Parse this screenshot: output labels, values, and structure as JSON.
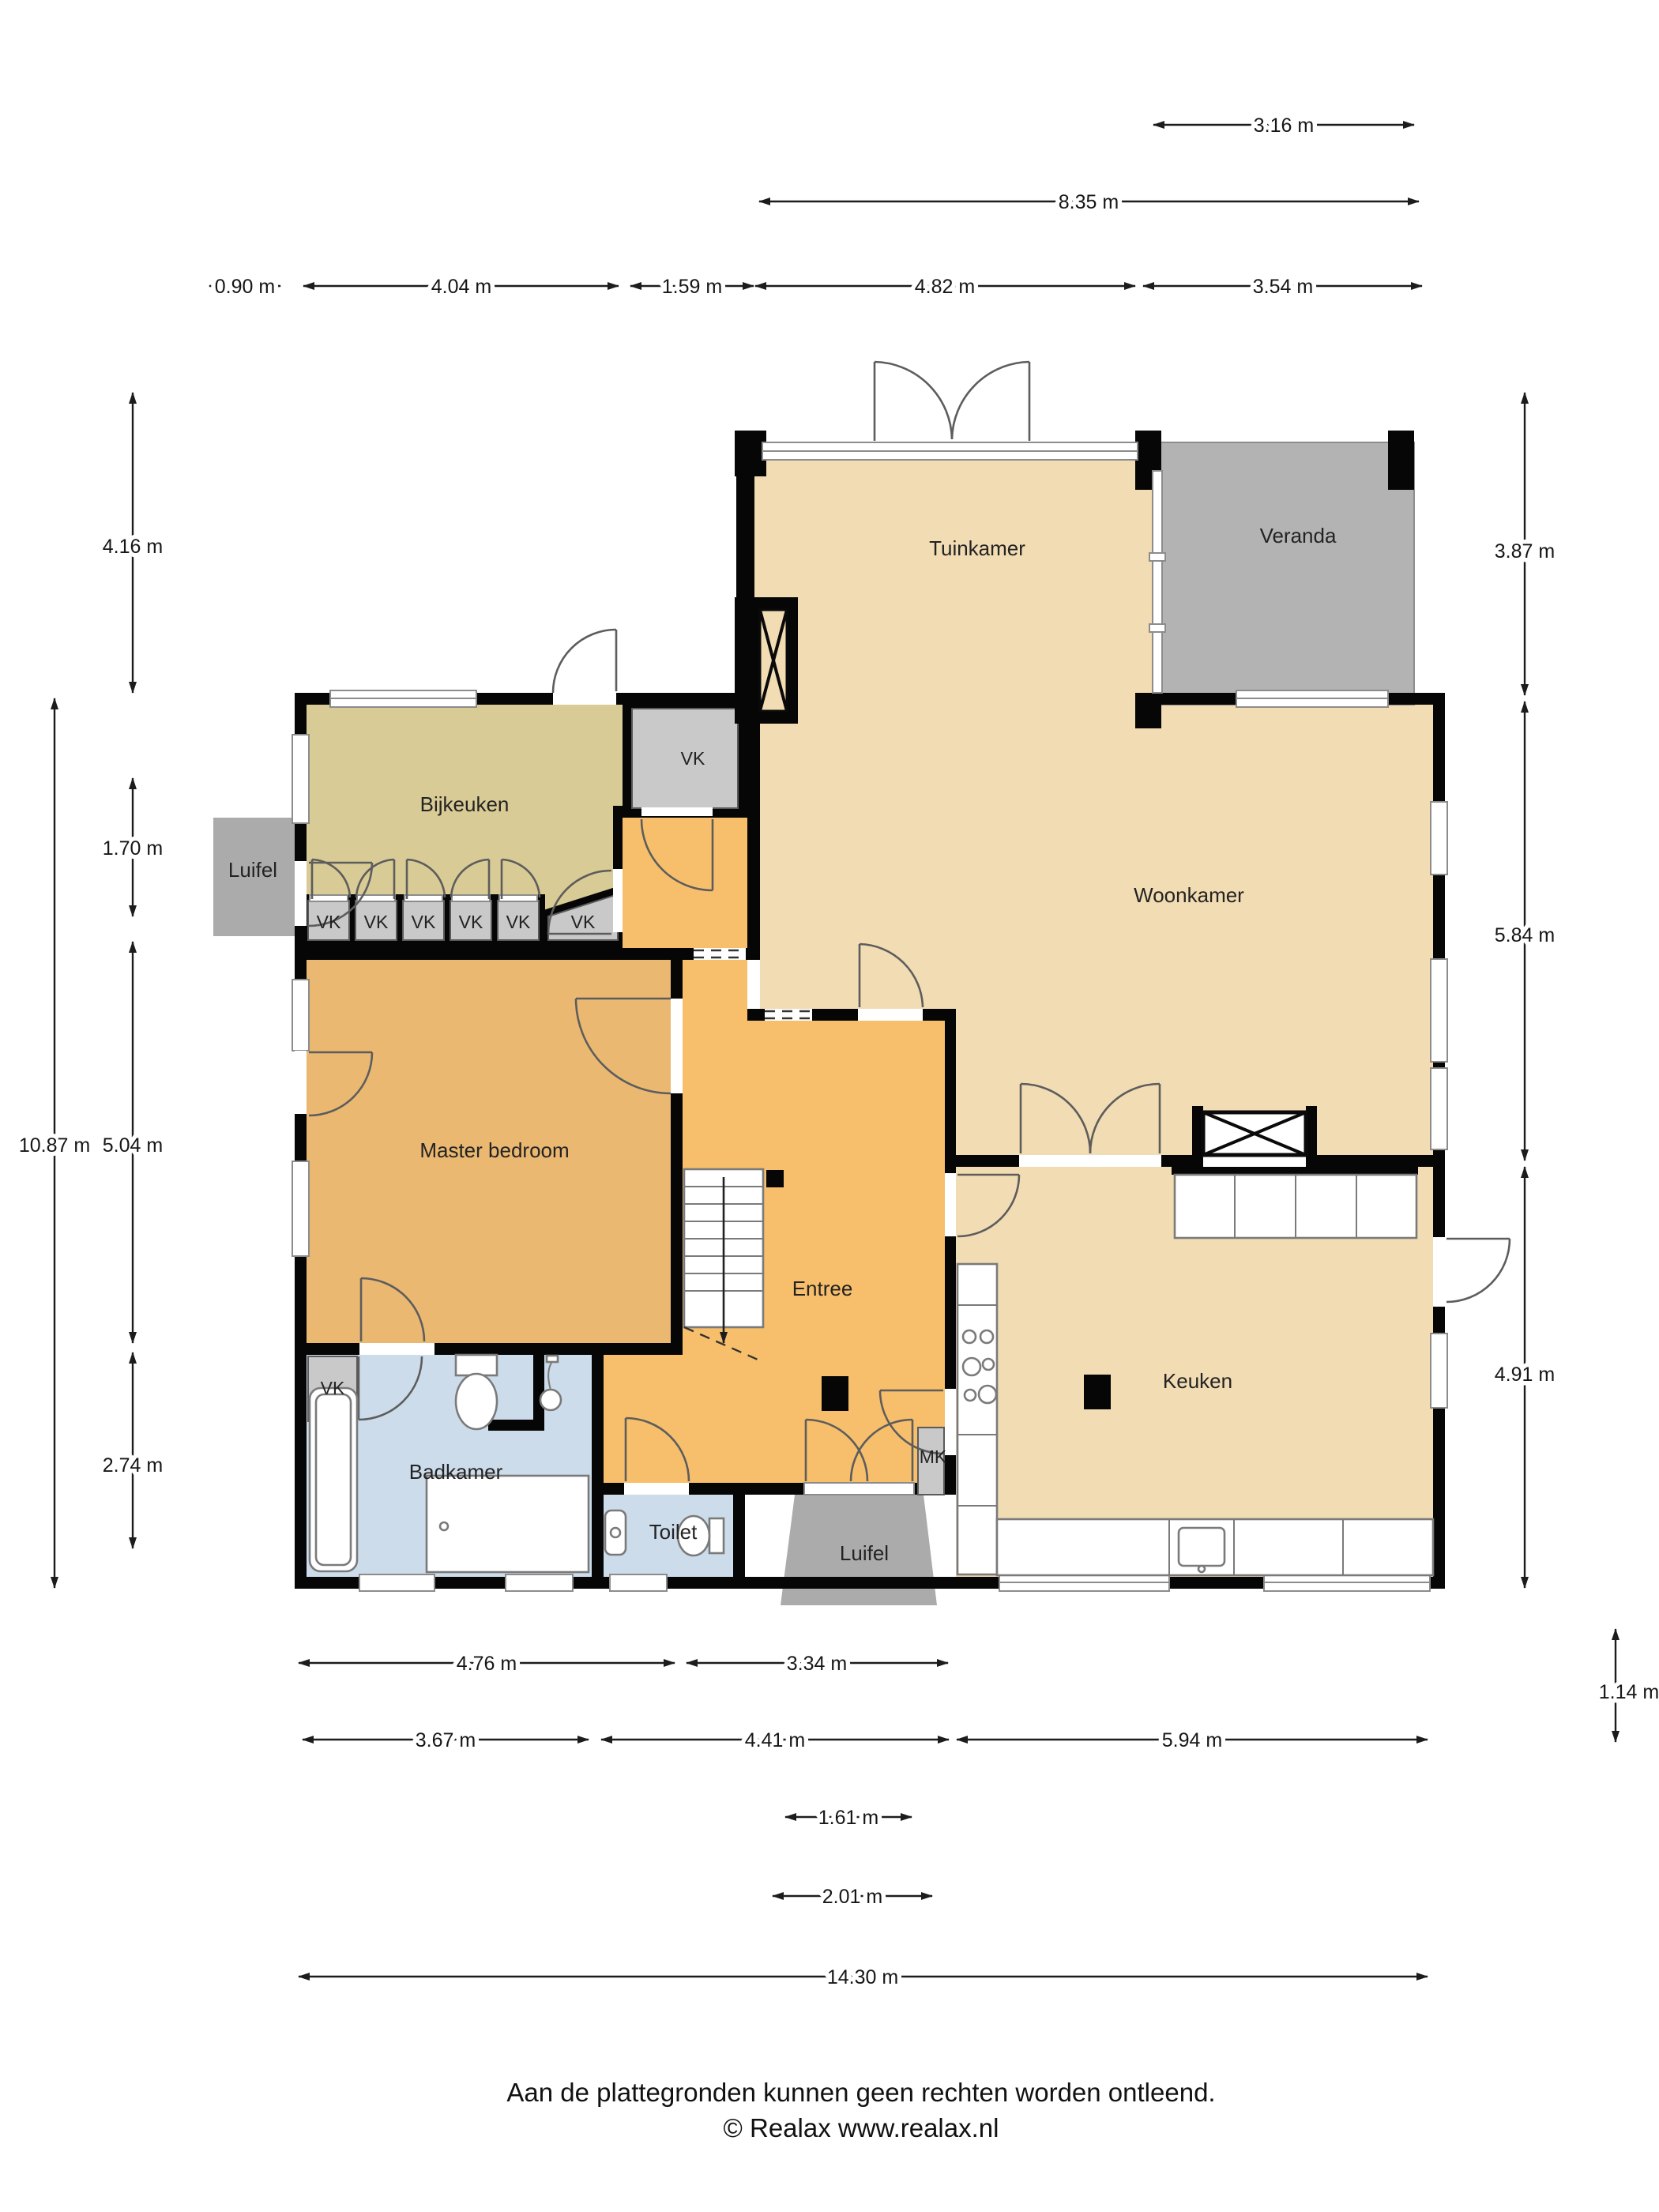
{
  "rooms": {
    "tuinkamer": "Tuinkamer",
    "veranda": "Veranda",
    "bijkeuken": "Bijkeuken",
    "woonkamer": "Woonkamer",
    "master_bedroom": "Master bedroom",
    "entree": "Entree",
    "keuken": "Keuken",
    "badkamer": "Badkamer",
    "toilet": "Toilet",
    "luifel_left": "Luifel",
    "luifel_front": "Luifel"
  },
  "closets": {
    "vk_main": "VK",
    "vk_row": [
      "VK",
      "VK",
      "VK",
      "VK",
      "VK"
    ],
    "vk_slanted": "VK",
    "vk_badkamer": "VK",
    "mk": "MK"
  },
  "dimensions": {
    "top": [
      {
        "label": "3.16 m"
      },
      {
        "label": "8.35 m"
      },
      {
        "label": "0.90 m"
      },
      {
        "label": "4.04 m"
      },
      {
        "label": "1.59 m"
      },
      {
        "label": "4.82 m"
      },
      {
        "label": "3.54 m"
      }
    ],
    "left": [
      {
        "label": "4.16 m"
      },
      {
        "label": "1.70 m"
      },
      {
        "label": "5.04 m"
      },
      {
        "label": "2.74 m"
      },
      {
        "label": "10.87 m"
      }
    ],
    "right": [
      {
        "label": "3.87 m"
      },
      {
        "label": "5.84 m"
      },
      {
        "label": "4.91 m"
      },
      {
        "label": "1.14 m"
      }
    ],
    "bottom": [
      {
        "label": "4.76 m"
      },
      {
        "label": "3.34 m"
      },
      {
        "label": "3.67 m"
      },
      {
        "label": "4.41 m"
      },
      {
        "label": "5.94 m"
      },
      {
        "label": "1.61 m"
      },
      {
        "label": "2.01 m"
      },
      {
        "label": "14.30 m"
      }
    ]
  },
  "footer": {
    "line1": "Aan de plattegronden kunnen geen rechten worden ontleend.",
    "line2": "© Realax www.realax.nl"
  },
  "colors": {
    "floor_beige": "#F2DCB3",
    "floor_olive": "#D9CB95",
    "floor_orange": "#F7BF6C",
    "floor_tan": "#EAB871",
    "floor_blue": "#CDDCEB",
    "veranda_gray": "#B3B3B3",
    "luifel_gray": "#ABABAB",
    "closet_gray": "#C9C9C9",
    "wall_black": "#060606"
  }
}
